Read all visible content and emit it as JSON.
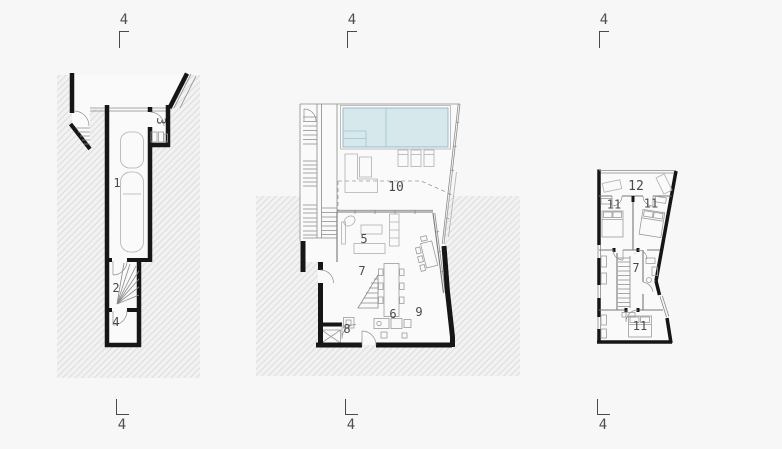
{
  "drawing": {
    "kind": "architectural-floor-plans",
    "section_marker_label": "4"
  },
  "markers": {
    "top": [
      {
        "label": "4"
      },
      {
        "label": "4"
      },
      {
        "label": "4"
      }
    ],
    "bottom": [
      {
        "label": "4"
      },
      {
        "label": "4"
      },
      {
        "label": "4"
      }
    ]
  },
  "plans": {
    "lower": {
      "rooms": [
        {
          "label": "1"
        },
        {
          "label": "2"
        },
        {
          "label": "3"
        },
        {
          "label": "4"
        }
      ]
    },
    "main": {
      "rooms": [
        {
          "label": "5"
        },
        {
          "label": "6"
        },
        {
          "label": "7"
        },
        {
          "label": "8"
        },
        {
          "label": "9"
        },
        {
          "label": "10"
        }
      ]
    },
    "upper": {
      "rooms": [
        {
          "label": "7"
        },
        {
          "label": "11"
        },
        {
          "label": "11"
        },
        {
          "label": "11"
        },
        {
          "label": "12"
        }
      ]
    }
  },
  "colors": {
    "background": "#f7f7f7",
    "wall": "#161616",
    "pool_fill": "#d7e8ec",
    "pool_edge": "#93b7c0",
    "hatch_line": "#dcdcdc",
    "label_text": "#4a4a4a"
  }
}
